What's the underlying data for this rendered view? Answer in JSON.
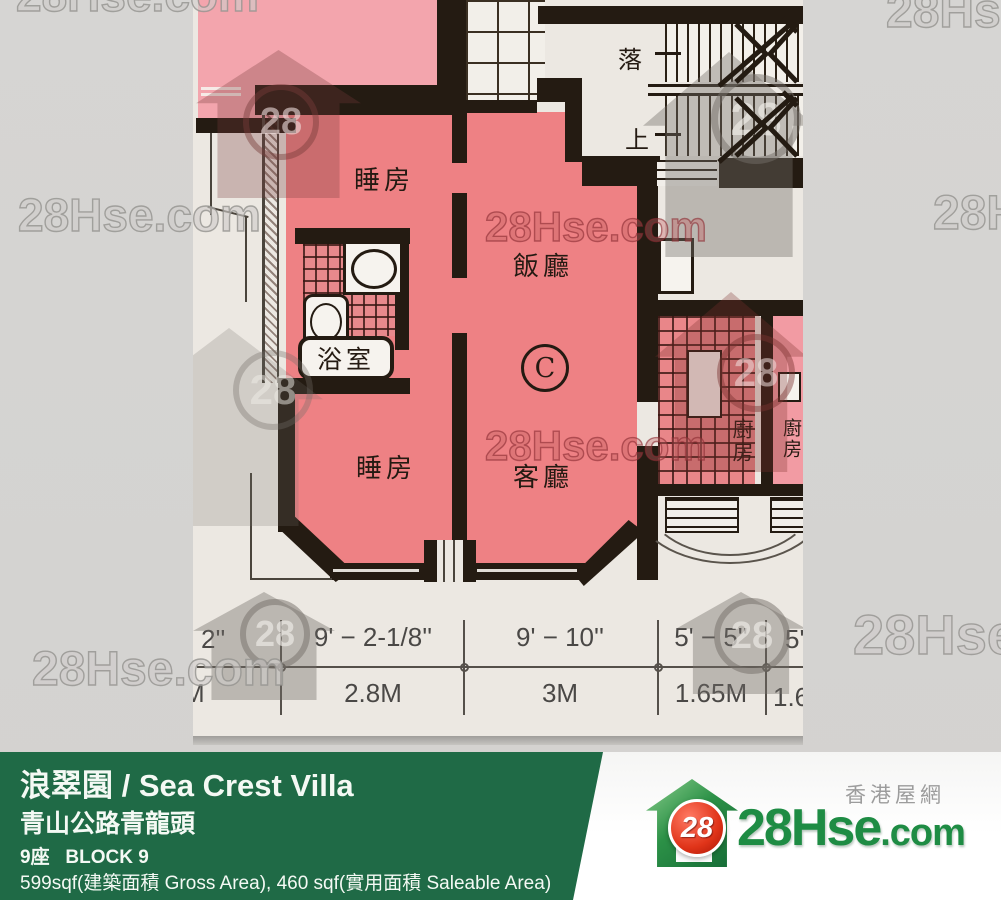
{
  "watermarks": {
    "brand_text": "28Hse.com",
    "badge": "28"
  },
  "floorplan": {
    "rooms": {
      "bedroom_top": "睡房",
      "bedroom_bottom": "睡房",
      "dining": "飯廳",
      "living": "客廳",
      "bathroom": "浴室",
      "kitchen_left": "廚房",
      "kitchen_right": "廚房",
      "unit": "C",
      "stairs_down": "落",
      "stairs_up": "上"
    },
    "dimensions": {
      "top_row": [
        "2''",
        "9' − 2-1/8''",
        "9' − 10''",
        "5' − 5''",
        "5'"
      ],
      "bottom_row": [
        "M",
        "2.8M",
        "3M",
        "1.65M",
        "1.6"
      ]
    }
  },
  "banner": {
    "title": "浪翠園 / Sea Crest Villa",
    "address": "青山公路青龍頭",
    "block": "9座   BLOCK 9",
    "area": "599sqf(建築面積 Gross Area), 460 sqf(實用面積 Saleable Area)",
    "color": "#1f6a46"
  },
  "logo": {
    "site_name": "香港屋網",
    "brand": "28Hse",
    "suffix": ".com",
    "badge": "28"
  }
}
